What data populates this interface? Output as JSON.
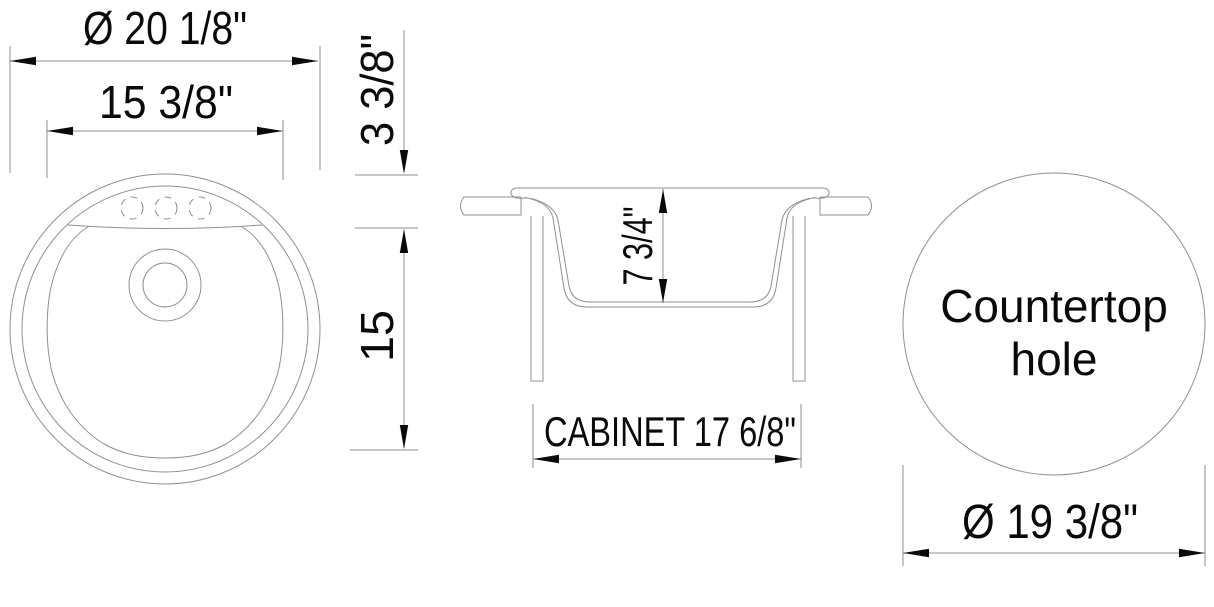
{
  "drawing": {
    "type": "sink specification drawing",
    "colors": {
      "background": "#ffffff",
      "line": "#909090",
      "text": "#0a0a0a",
      "arrow": "#0a0a0a"
    },
    "top_view": {
      "dim_outer_diameter": "Ø 20  1/8\"",
      "dim_bowl_diameter": "15  3/8\"",
      "dim_deck_depth": "3 3/8\"",
      "dim_bowl_front_back": "15",
      "faucet_holes_count": "3"
    },
    "section_view": {
      "dim_bowl_depth": "7 3/4\"",
      "dim_cabinet_width": "CABINET 17  6/8\""
    },
    "countertop_view": {
      "label_line1": "Countertop",
      "label_line2": "hole",
      "dim_hole_diameter": "Ø 19  3/8\""
    }
  }
}
